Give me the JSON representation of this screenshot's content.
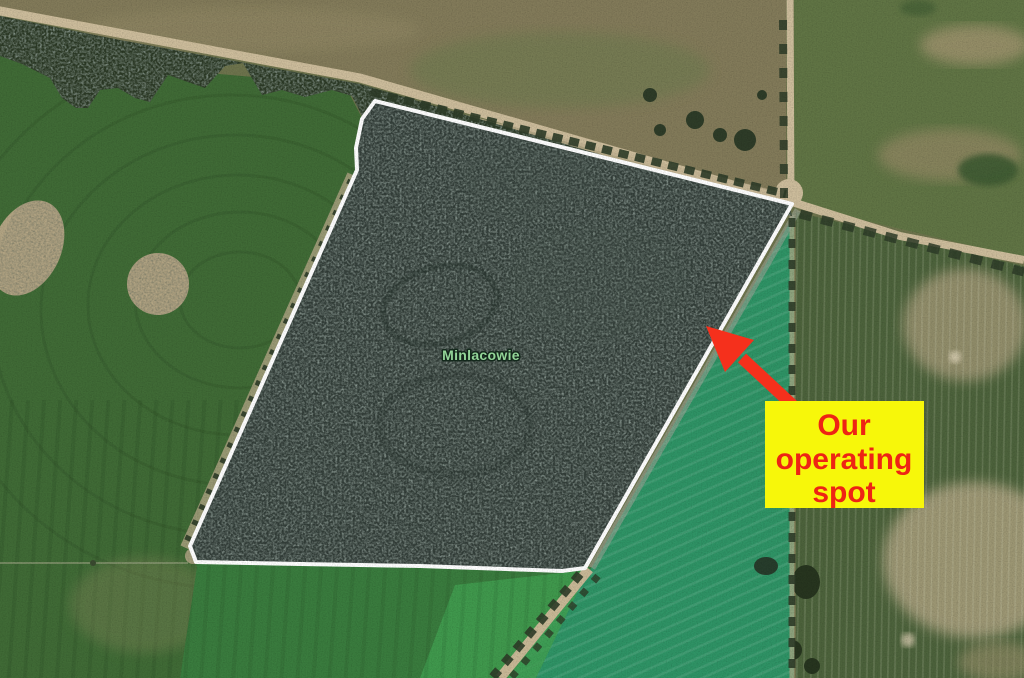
{
  "map": {
    "area_label": "Minlacowie",
    "callout": {
      "lines": [
        "Our",
        "operating",
        "spot"
      ]
    },
    "colors": {
      "boundary_outline": "#ffffff",
      "forest_fill": "#333e39",
      "arrow_red": "#f5301c",
      "callout_bg": "#f7f70a",
      "callout_text": "#ee2414",
      "area_label_text": "#93d598",
      "teal_field": "#2f9466",
      "left_field_green": "#406b36",
      "road_tan": "#cdbd9c"
    }
  }
}
